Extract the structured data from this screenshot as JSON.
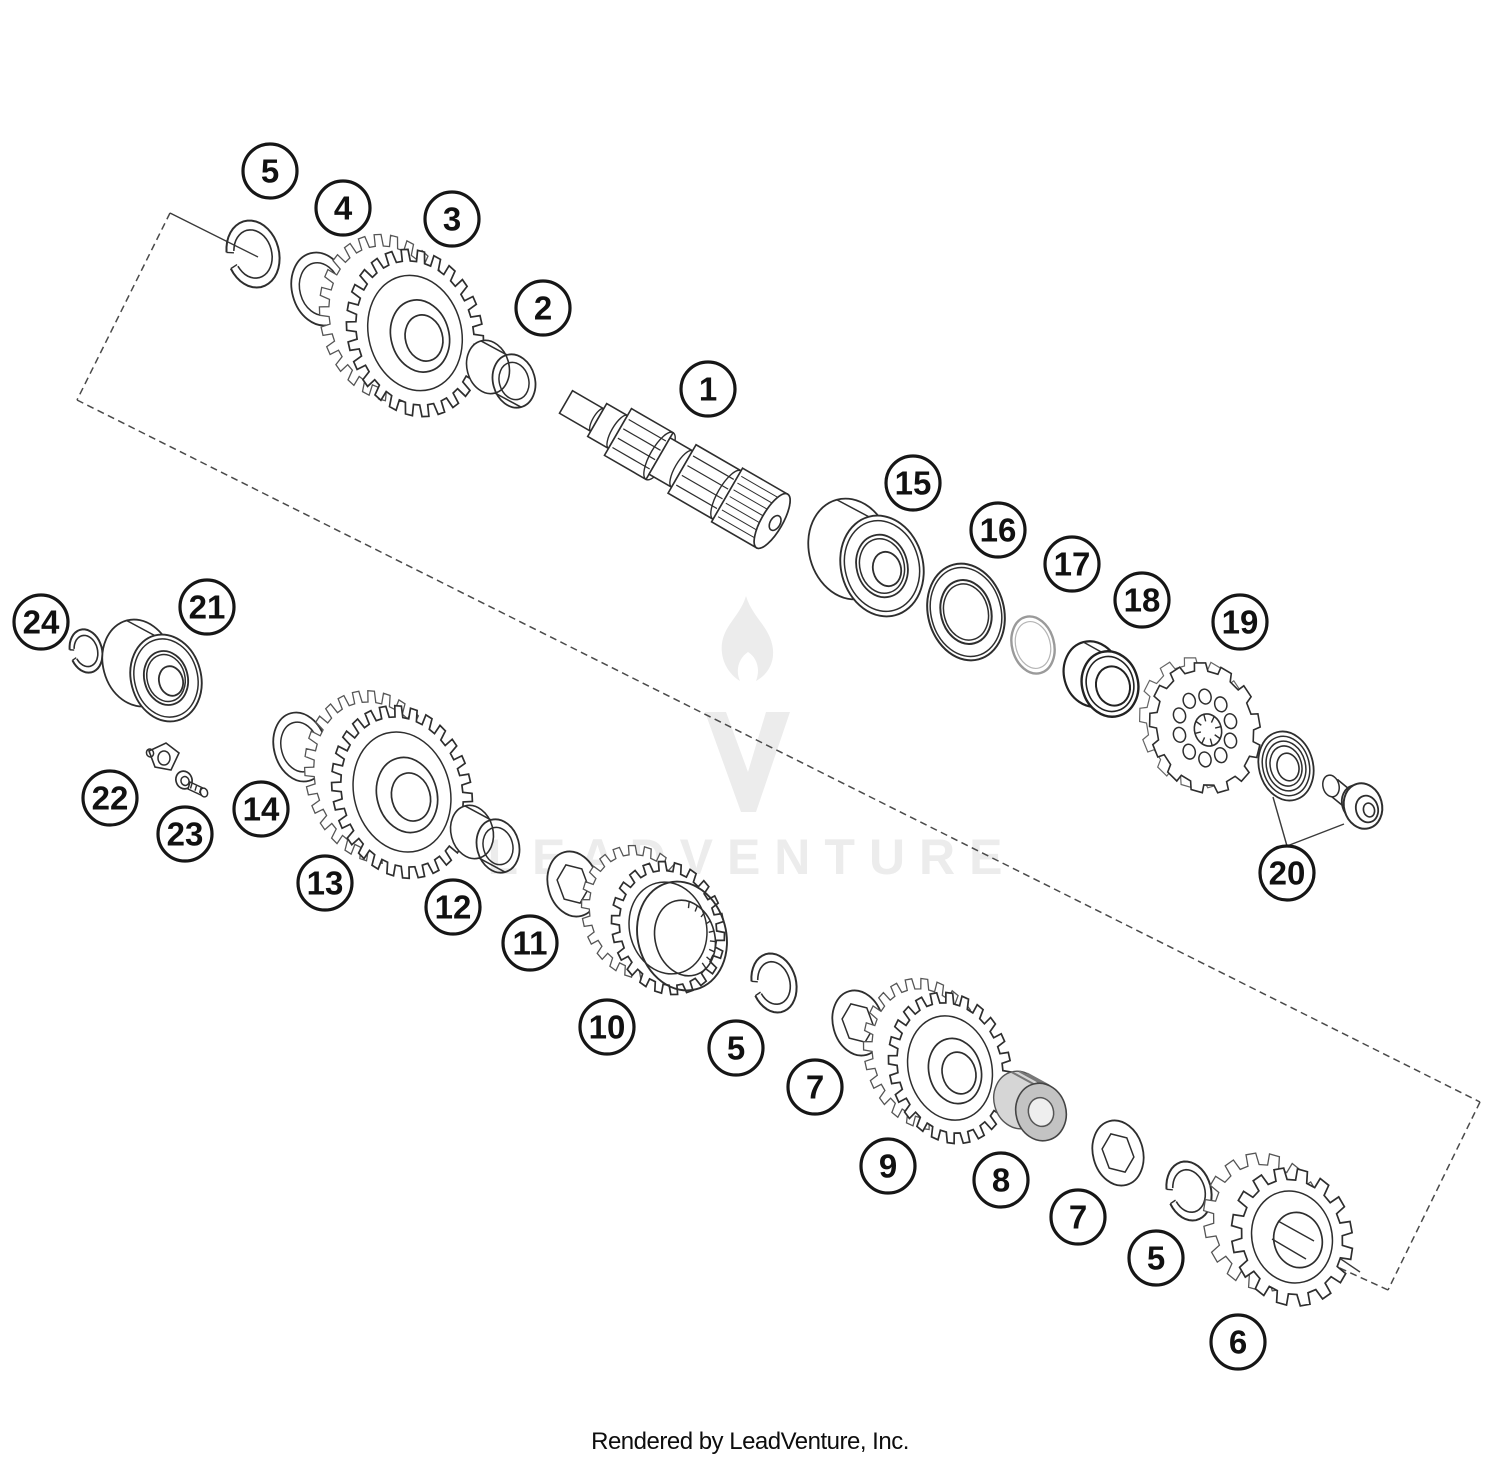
{
  "page": {
    "footer": "Rendered by LeadVenture, Inc.",
    "background": "#ffffff"
  },
  "watermark": {
    "text": "LEADVENTURE",
    "text_color": "#ececec",
    "logo_color": "#ececec",
    "text_x": 752,
    "text_y": 874,
    "font_size": 50,
    "letter_spacing": 14,
    "flame_cx": 746,
    "flame_cy": 640,
    "v_cx": 747,
    "v_cy": 762
  },
  "diagram": {
    "stroke_color": "#2e2e2e",
    "dash_color": "#4a4a4a",
    "callout_style": {
      "radius": 27,
      "stroke": "#161616",
      "stroke_width": 3.2,
      "font_size": 33
    },
    "callouts": [
      {
        "label": "5",
        "x": 270,
        "y": 171
      },
      {
        "label": "4",
        "x": 343,
        "y": 208
      },
      {
        "label": "3",
        "x": 452,
        "y": 219
      },
      {
        "label": "2",
        "x": 543,
        "y": 308
      },
      {
        "label": "1",
        "x": 708,
        "y": 389
      },
      {
        "label": "15",
        "x": 913,
        "y": 483
      },
      {
        "label": "16",
        "x": 998,
        "y": 530
      },
      {
        "label": "17",
        "x": 1072,
        "y": 564
      },
      {
        "label": "18",
        "x": 1142,
        "y": 600
      },
      {
        "label": "19",
        "x": 1240,
        "y": 622
      },
      {
        "label": "24",
        "x": 41,
        "y": 622
      },
      {
        "label": "21",
        "x": 207,
        "y": 607
      },
      {
        "label": "22",
        "x": 110,
        "y": 798
      },
      {
        "label": "23",
        "x": 185,
        "y": 834
      },
      {
        "label": "14",
        "x": 261,
        "y": 809
      },
      {
        "label": "13",
        "x": 325,
        "y": 883
      },
      {
        "label": "12",
        "x": 453,
        "y": 907
      },
      {
        "label": "11",
        "x": 530,
        "y": 943
      },
      {
        "label": "10",
        "x": 607,
        "y": 1027
      },
      {
        "label": "5",
        "x": 736,
        "y": 1048
      },
      {
        "label": "7",
        "x": 815,
        "y": 1087
      },
      {
        "label": "9",
        "x": 888,
        "y": 1166
      },
      {
        "label": "8",
        "x": 1001,
        "y": 1180
      },
      {
        "label": "7",
        "x": 1078,
        "y": 1217
      },
      {
        "label": "5",
        "x": 1156,
        "y": 1258
      },
      {
        "label": "6",
        "x": 1238,
        "y": 1342
      },
      {
        "label": "20",
        "x": 1287,
        "y": 873
      }
    ],
    "dashed_lines": [
      {
        "x1": 170,
        "y1": 213,
        "x2": 77,
        "y2": 400
      },
      {
        "x1": 77,
        "y1": 400,
        "x2": 1480,
        "y2": 1102
      },
      {
        "x1": 1480,
        "y1": 1102,
        "x2": 1388,
        "y2": 1290
      },
      {
        "x1": 1388,
        "y1": 1290,
        "x2": 1331,
        "y2": 1264
      }
    ],
    "leader_lines": [
      {
        "x1": 170,
        "y1": 213,
        "x2": 258,
        "y2": 257
      },
      {
        "x1": 1295,
        "y1": 1228,
        "x2": 1360,
        "y2": 1272
      },
      {
        "x1": 1287,
        "y1": 846,
        "x2": 1273,
        "y2": 797
      },
      {
        "x1": 1287,
        "y1": 846,
        "x2": 1344,
        "y2": 824
      }
    ],
    "parts": [
      {
        "id": "snap-ring-5a",
        "type": "snapring",
        "cx": 253,
        "cy": 254,
        "rx": 26,
        "ry": 34,
        "rot": -15
      },
      {
        "id": "washer-4",
        "type": "washer",
        "cx": 320,
        "cy": 289,
        "rx": 28,
        "ry": 37,
        "rot": -15
      },
      {
        "id": "gear-3",
        "type": "gear",
        "cx": 415,
        "cy": 333,
        "rx": 58,
        "ry": 73,
        "rot": -15,
        "teeth": 26,
        "toothH": 0.16,
        "depth": [
          -27,
          -15
        ]
      },
      {
        "id": "bushing-2",
        "type": "bushing",
        "cx": 514,
        "cy": 381,
        "rx": 21,
        "ry": 27,
        "rot": -15,
        "depth": [
          -26,
          -14
        ]
      },
      {
        "id": "shaft-1",
        "type": "shaft",
        "cx": 566,
        "cy": 402,
        "angle": 30,
        "len": 238
      },
      {
        "id": "bearing-15",
        "type": "bearing",
        "cx": 882,
        "cy": 566,
        "rx": 41,
        "ry": 51,
        "rot": -15,
        "depth": [
          -32,
          -17
        ]
      },
      {
        "id": "seal-16",
        "type": "seal",
        "cx": 966,
        "cy": 612,
        "rx": 38,
        "ry": 49,
        "rot": -15
      },
      {
        "id": "o-ring-17",
        "type": "oring",
        "cx": 1033,
        "cy": 645,
        "rx": 21,
        "ry": 29,
        "rot": -15
      },
      {
        "id": "collar-18",
        "type": "collar",
        "cx": 1110,
        "cy": 684,
        "rx": 28,
        "ry": 33,
        "rot": -15,
        "depth": [
          -18,
          -10
        ]
      },
      {
        "id": "sprocket-19",
        "type": "sprocket",
        "cx": 1205,
        "cy": 728,
        "rx": 48,
        "ry": 58,
        "rot": -15,
        "teeth": 13
      },
      {
        "id": "washer-20",
        "type": "thrustwasher",
        "cx": 1286,
        "cy": 766,
        "rx": 27,
        "ry": 35,
        "rot": -15
      },
      {
        "id": "bolt-20",
        "type": "bolt",
        "cx": 1362,
        "cy": 806
      },
      {
        "id": "ring-24",
        "type": "snapring",
        "cx": 86,
        "cy": 651,
        "rx": 16,
        "ry": 22,
        "rot": -15
      },
      {
        "id": "bearing-21",
        "type": "bearing",
        "cx": 166,
        "cy": 678,
        "rx": 35,
        "ry": 44,
        "rot": -15,
        "depth": [
          -28,
          -15
        ]
      },
      {
        "id": "oil-jet-22",
        "type": "oiljet",
        "cx": 162,
        "cy": 760
      },
      {
        "id": "screw-23",
        "type": "screw",
        "cx": 184,
        "cy": 780
      },
      {
        "id": "washer-14",
        "type": "washer",
        "cx": 300,
        "cy": 747,
        "rx": 26,
        "ry": 35,
        "rot": -15
      },
      {
        "id": "gear-13",
        "type": "gear",
        "cx": 402,
        "cy": 792,
        "rx": 60,
        "ry": 76,
        "rot": -15,
        "teeth": 28,
        "toothH": 0.15,
        "depth": [
          -27,
          -15
        ]
      },
      {
        "id": "bushing-12",
        "type": "bushing",
        "cx": 498,
        "cy": 846,
        "rx": 21,
        "ry": 27,
        "rot": -15,
        "depth": [
          -26,
          -14
        ]
      },
      {
        "id": "lock-washer-11",
        "type": "lockwasher",
        "cx": 573,
        "cy": 884,
        "rx": 25,
        "ry": 33,
        "rot": -15
      },
      {
        "id": "gear-10",
        "type": "synchro",
        "cx": 668,
        "cy": 928,
        "rx": 48,
        "ry": 58,
        "rot": -15,
        "teeth": 22,
        "toothH": 0.16,
        "depth": [
          -30,
          -16
        ]
      },
      {
        "id": "snap-ring-5b",
        "type": "snapring",
        "cx": 774,
        "cy": 983,
        "rx": 22,
        "ry": 30,
        "rot": -15
      },
      {
        "id": "lock-washer-7a",
        "type": "lockwasher",
        "cx": 858,
        "cy": 1023,
        "rx": 25,
        "ry": 33,
        "rot": -15
      },
      {
        "id": "gear-9",
        "type": "gear",
        "cx": 950,
        "cy": 1068,
        "rx": 52,
        "ry": 66,
        "rot": -15,
        "teeth": 24,
        "toothH": 0.16,
        "depth": [
          -25,
          -14
        ]
      },
      {
        "id": "needle-bearing-8",
        "type": "needle",
        "cx": 1041,
        "cy": 1112,
        "rx": 25,
        "ry": 29,
        "rot": -15,
        "depth": [
          -22,
          -12
        ]
      },
      {
        "id": "lock-washer-7b",
        "type": "lockwasher",
        "cx": 1118,
        "cy": 1153,
        "rx": 25,
        "ry": 33,
        "rot": -15
      },
      {
        "id": "snap-ring-5c",
        "type": "snapring",
        "cx": 1189,
        "cy": 1191,
        "rx": 22,
        "ry": 30,
        "rot": -15
      },
      {
        "id": "gear-6",
        "type": "gear6",
        "cx": 1292,
        "cy": 1237,
        "rx": 50,
        "ry": 58,
        "rot": -15,
        "teeth": 16,
        "toothH": 0.2,
        "depth": [
          -28,
          -15
        ]
      }
    ]
  }
}
